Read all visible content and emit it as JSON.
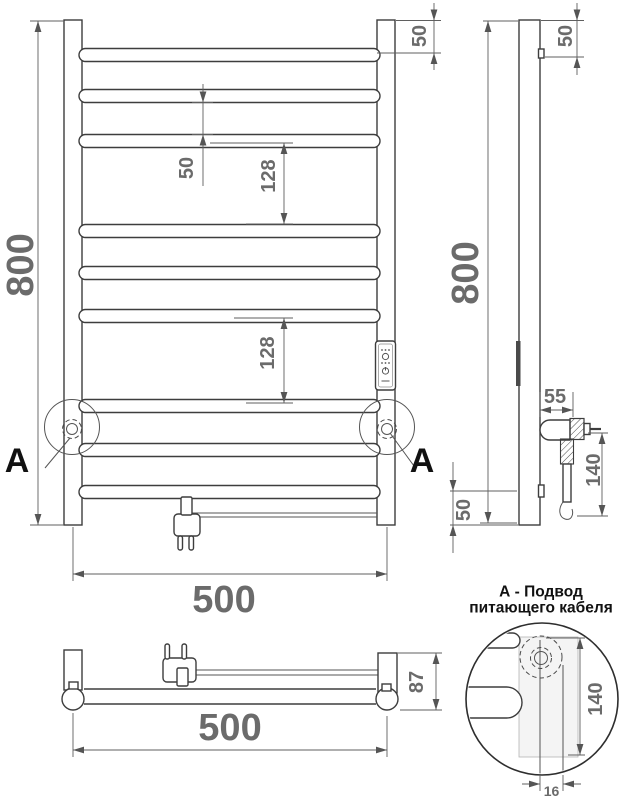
{
  "drawing": {
    "front": {
      "height": "800",
      "width": "500",
      "top_offset": "50",
      "rung_spacing": "50",
      "gap_upper": "128",
      "gap_lower": "128",
      "marker_left": "А",
      "marker_right": "А"
    },
    "side": {
      "height": "800",
      "top_offset": "50",
      "bottom_offset": "50",
      "bracket_depth": "55",
      "cable_length": "140"
    },
    "bottom": {
      "width": "500",
      "depth": "87"
    },
    "detail": {
      "title_line1": "А - Подвод",
      "title_line2": "питающего кабеля",
      "cable_length": "140",
      "tube_width": "16"
    }
  }
}
